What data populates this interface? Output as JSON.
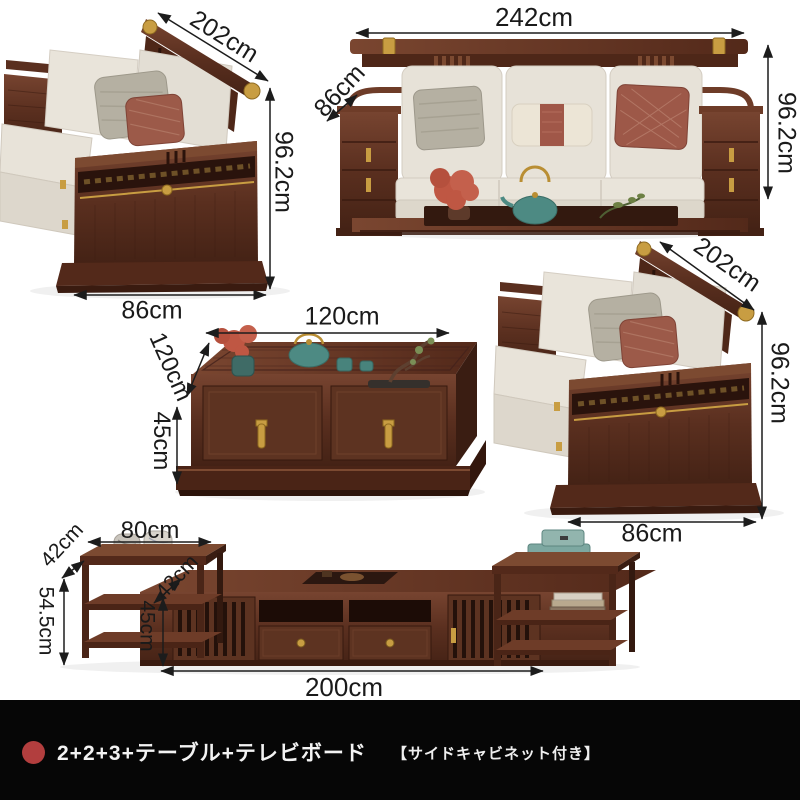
{
  "background": "#ffffff",
  "pieces": {
    "loveseat_top_left": {
      "name": "two-seat sofa (side view)",
      "dims": {
        "back_rail": "202cm",
        "height": "96.2cm",
        "base_width": "86cm"
      }
    },
    "sofa_three_seat": {
      "name": "three-seat sofa (front view)",
      "dims": {
        "width": "242cm",
        "seat_depth": "86cm",
        "height": "96.2cm"
      }
    },
    "tea_table": {
      "name": "tea table",
      "dims": {
        "width": "120cm",
        "depth": "120cm",
        "height": "45cm"
      }
    },
    "loveseat_middle_right": {
      "name": "two-seat sofa (side view)",
      "dims": {
        "back_rail": "202cm",
        "height": "96.2cm",
        "base_width": "86cm"
      }
    },
    "tv_stand": {
      "name": "TV board with side cabinets",
      "dims": {
        "side_table_width": "80cm",
        "side_table_depth": "42cm",
        "side_table_height": "54.5cm",
        "cabinet_depth": "42cm",
        "cabinet_height": "45cm",
        "cabinet_width": "200cm"
      }
    }
  },
  "footer": {
    "marker_color": "#b23e3e",
    "background": "#060606",
    "set_name": "2+2+3+テーブル+テレビボード",
    "note": "【サイドキャビネット付き】"
  },
  "colors": {
    "wood": "#5d3321",
    "wood_dark": "#3a1b10",
    "cushion": "#e8e3d9",
    "pillow_red": "#9d5848",
    "pillow_gray": "#b5b0a2",
    "gold": "#c89d42",
    "teal": "#4d8a83",
    "plant_red": "#bf5743",
    "dimension_text": "#1a1a1a"
  }
}
